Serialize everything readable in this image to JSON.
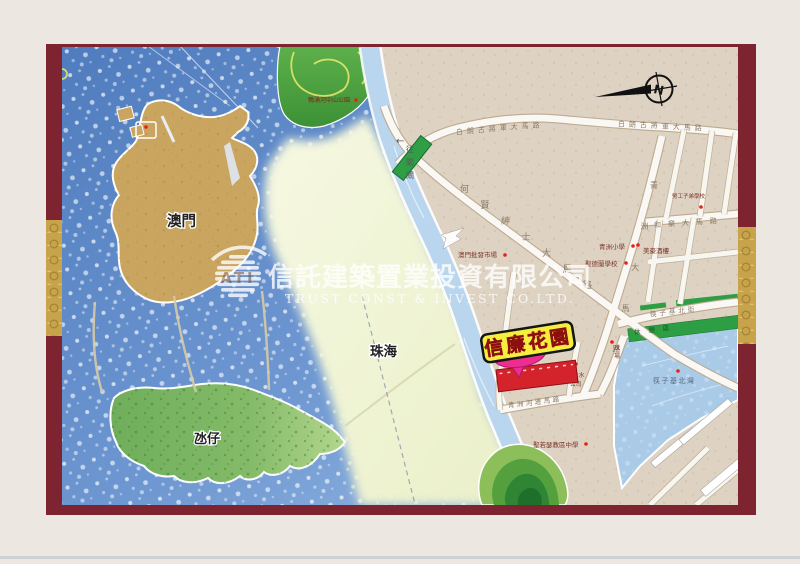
{
  "watermark": {
    "logo": "ATI",
    "company_zh": "信託建築置業投資有限公司",
    "company_en": "TRUST CONST & INVEST CO.LTD."
  },
  "map": {
    "areas": {
      "macau": "澳門",
      "taipa": "氹仔",
      "zhuhai": "珠海"
    },
    "project": {
      "name": "信廉花園"
    },
    "compass": {
      "north": "N"
    },
    "direction_sign": {
      "arrow": "←",
      "label": "往關閘"
    },
    "roads": {
      "castelo_branco_w": "白朗古將軍大馬路",
      "castelo_branco_e": "白朗古將軍大馬路",
      "ho_yin": "何賢紳士大馬路",
      "concordia": "和樂大馬路",
      "ilha_verde": "青洲大馬路",
      "fai_chi_kei_north": "筷子基北街",
      "riverside": "青洲河邊馬路"
    },
    "landmarks": {
      "park": "鴨涌河中山公園",
      "wholesale_market": "澳門批發市場",
      "qingzhou_school": "青洲小學",
      "st_teresa_school": "聖德蘭學校",
      "restaurant": "美豪酒樓",
      "workers_school": "勞工子弟學校",
      "water_company_l1": "自來水",
      "water_company_l2": "公司",
      "sports_court": "球場",
      "bay": "筷子基北灣",
      "st_joseph_school": "聖若瑟教區中學",
      "green_strip": "休憩區"
    }
  },
  "colors": {
    "frame_maroon": "#7e2430",
    "frame_gold": "#c7a44b",
    "project_red": "#d5232b",
    "sign_yellow": "#f6ee3e",
    "sign_text_red": "#d81f1f",
    "bubble_magenta": "#ee2d90"
  }
}
